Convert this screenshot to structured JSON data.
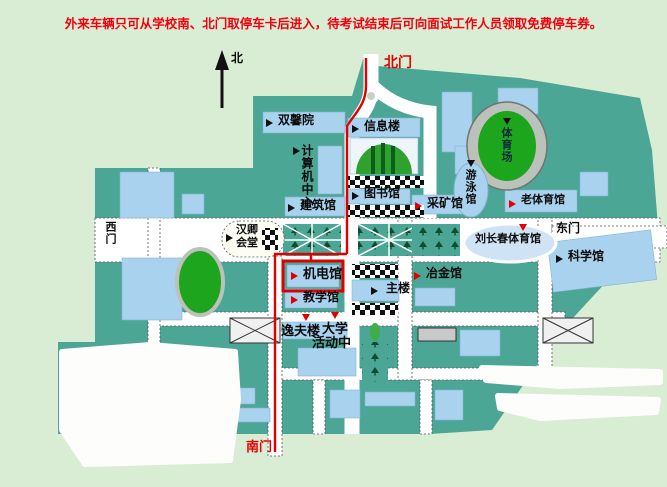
{
  "notice": {
    "text": "外来车辆只可从学校南、北门取停车卡后进入，待考试结束后可向面试工作人员领取免费停车券。",
    "color": "#f2000e"
  },
  "compass": {
    "north_label": "北"
  },
  "gates": {
    "north": "北门",
    "south": "南门",
    "west": "西门",
    "east": "东门"
  },
  "buildings": {
    "shuangxinyuan": "双馨院",
    "computer_center": "计算机中心",
    "info_building": "信息楼",
    "library": "图书馆",
    "architecture": "建筑馆",
    "mining": "采矿馆",
    "swimming": "游泳馆",
    "stadium": "体育场",
    "old_gym": "老体育馆",
    "hanqing_hall_line1": "汉卿",
    "hanqing_hall_line2": "会堂",
    "liu_changchun_gym": "刘长春体育馆",
    "science": "科学馆",
    "mech_elec": "机电馆",
    "teaching": "教学馆",
    "main_building": "主楼",
    "metallurgy": "冶金馆",
    "yifu": "逸夫楼",
    "activity_center_line1": "大学",
    "activity_center_line2": "活动中"
  },
  "colors": {
    "background": "#d9edd4",
    "campus": "#4ba695",
    "building": "#a9d2ee",
    "road": "#ffffff",
    "route_red": "#e00000",
    "field_green": "#1ea51e",
    "track_gray": "#bcc1bc",
    "notice_red": "#f2000e"
  }
}
